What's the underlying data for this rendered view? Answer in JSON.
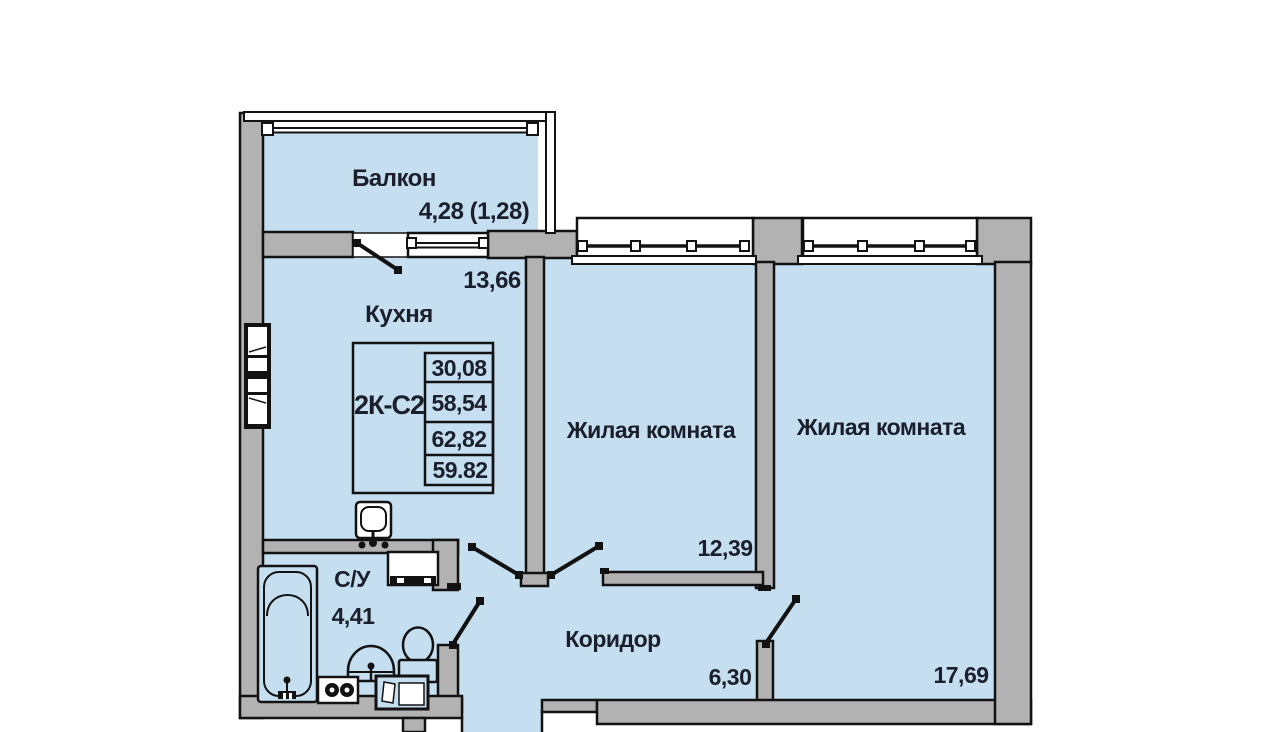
{
  "plan_title": "2К-С2",
  "info_table": {
    "values": [
      "30,08",
      "58,54",
      "62,82",
      "59.82"
    ]
  },
  "rooms": {
    "balcony": {
      "label": "Балкон",
      "area": "4,28 (1,28)"
    },
    "kitchen": {
      "label": "Кухня",
      "area": "13,66"
    },
    "living_room_1": {
      "label": "Жилая комната",
      "area": "12,39"
    },
    "living_room_2": {
      "label": "Жилая комната",
      "area": "17,69"
    },
    "corridor": {
      "label": "Коридор",
      "area": "6,30"
    },
    "bathroom": {
      "label": "С/У",
      "area": "4,41"
    }
  },
  "colors": {
    "floor_fill": "#c5def0",
    "wall_fill": "#b3b2b2",
    "outline": "#121212",
    "label_text": "#1a1f2b"
  }
}
